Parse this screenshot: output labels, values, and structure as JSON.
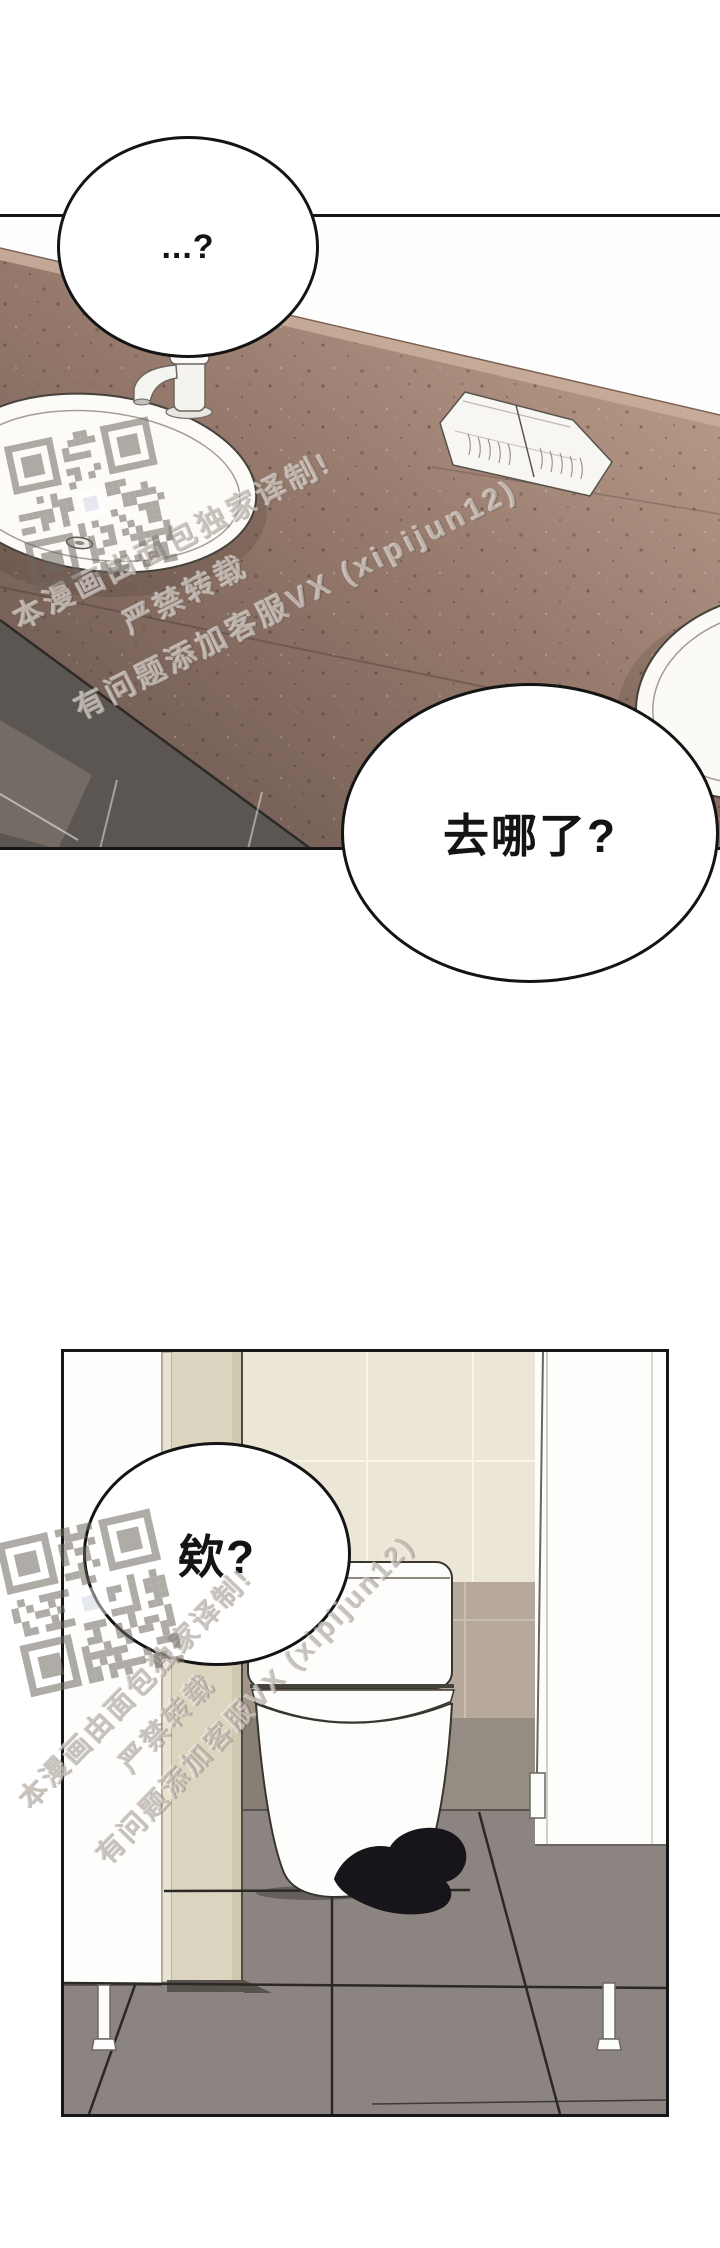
{
  "comic": {
    "panel1": {
      "bubble_top": "...?",
      "bubble_bottom": "去哪了?"
    },
    "panel2": {
      "bubble": "欸?"
    },
    "watermark": {
      "line1": "本漫画由面包独家译制!",
      "line2": "严禁转载",
      "line3": "有问题添加客服VX (xipijun12)"
    },
    "colors": {
      "counter_light": "#b49786",
      "counter_dark": "#6b5850",
      "tile_front": "#5b5651",
      "floor": "#8b8480",
      "wall_cream": "#ece6d6",
      "wall_taupe": "#b6a89a",
      "door_beige": "#dbd5bf",
      "cap_black": "#17141a",
      "outline": "#141414"
    }
  }
}
